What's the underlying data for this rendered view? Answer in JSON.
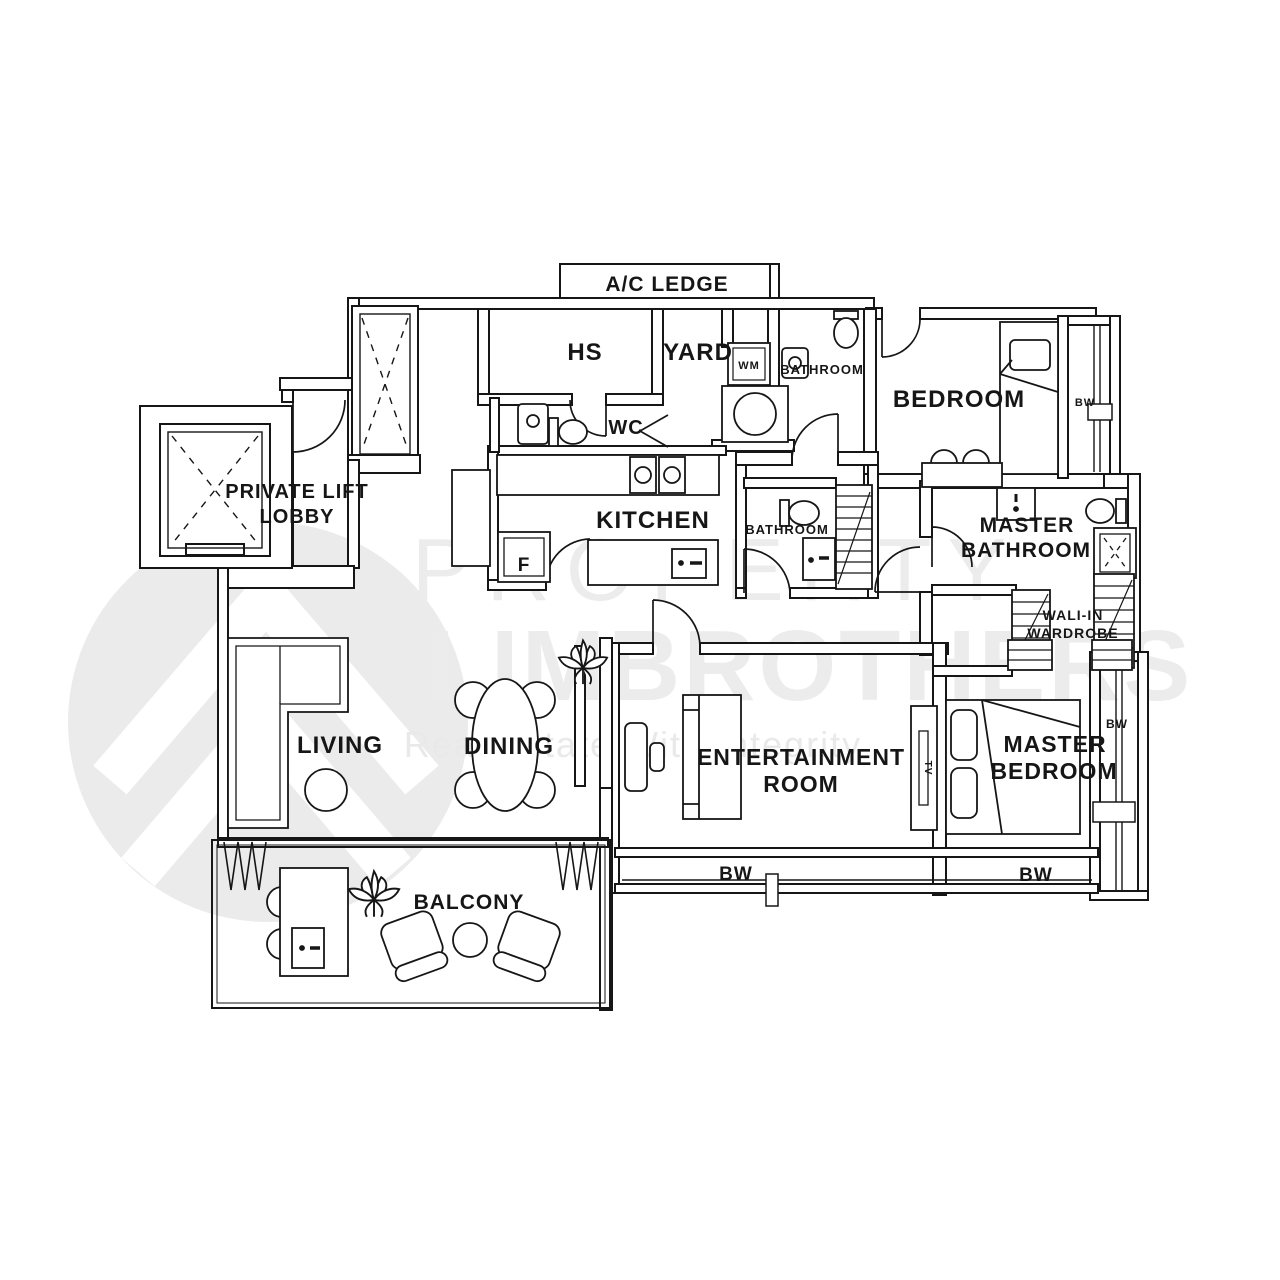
{
  "watermark": {
    "brand_1": "PROPERTY",
    "brand_2": "LIMBROTHERS",
    "tagline": "Real Estate With Integrity"
  },
  "labels": {
    "ac_ledge": "A/C LEDGE",
    "hs": "HS",
    "yard": "YARD",
    "wm": "WM",
    "bathroom_top": "BATHROOM",
    "bedroom": "BEDROOM",
    "bw": "BW",
    "private_lift_1": "PRIVATE LIFT",
    "private_lift_2": "LOBBY",
    "wc": "WC",
    "kitchen": "KITCHEN",
    "fridge": "F",
    "bathroom_mid": "BATHROOM",
    "master_bath_1": "MASTER",
    "master_bath_2": "BATHROOM",
    "wardrobe_1": "WALI-IN",
    "wardrobe_2": "WARDROBE",
    "living": "LIVING",
    "dining": "DINING",
    "entertainment_1": "ENTERTAINMENT",
    "entertainment_2": "ROOM",
    "master_bed_1": "MASTER",
    "master_bed_2": "BEDROOM",
    "balcony": "BALCONY",
    "tv": "TV"
  },
  "colors": {
    "line": "#161616",
    "watermark": "#ececec"
  }
}
